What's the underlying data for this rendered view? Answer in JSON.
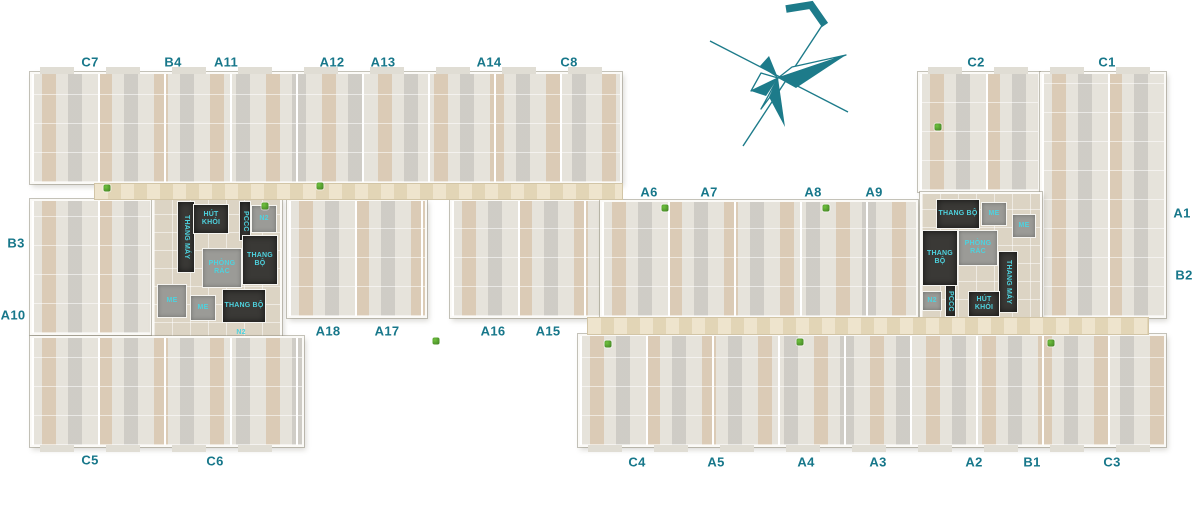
{
  "colors": {
    "label": "#17778a",
    "compass": "#1d7b8a",
    "core_text": "#4ed2de",
    "core_dark": "#3a3936",
    "room_gray": "#9b9b97",
    "floor": "#e6e3db",
    "corridor": "#e9ddc1"
  },
  "compass": {
    "icon": "compass-rose-north-arrow"
  },
  "unit_labels": [
    {
      "text": "C7",
      "x": 90,
      "y": 62
    },
    {
      "text": "B4",
      "x": 173,
      "y": 62
    },
    {
      "text": "A11",
      "x": 226,
      "y": 62
    },
    {
      "text": "A12",
      "x": 332,
      "y": 62
    },
    {
      "text": "A13",
      "x": 383,
      "y": 62
    },
    {
      "text": "A14",
      "x": 489,
      "y": 62
    },
    {
      "text": "C8",
      "x": 569,
      "y": 62
    },
    {
      "text": "C2",
      "x": 976,
      "y": 62
    },
    {
      "text": "C1",
      "x": 1107,
      "y": 62
    },
    {
      "text": "A6",
      "x": 649,
      "y": 192
    },
    {
      "text": "A7",
      "x": 709,
      "y": 192
    },
    {
      "text": "A8",
      "x": 813,
      "y": 192
    },
    {
      "text": "A9",
      "x": 874,
      "y": 192
    },
    {
      "text": "A1",
      "x": 1182,
      "y": 213
    },
    {
      "text": "B2",
      "x": 1184,
      "y": 275
    },
    {
      "text": "B3",
      "x": 16,
      "y": 243
    },
    {
      "text": "A10",
      "x": 13,
      "y": 315
    },
    {
      "text": "A18",
      "x": 328,
      "y": 331
    },
    {
      "text": "A17",
      "x": 387,
      "y": 331
    },
    {
      "text": "A16",
      "x": 493,
      "y": 331
    },
    {
      "text": "A15",
      "x": 548,
      "y": 331
    },
    {
      "text": "C5",
      "x": 90,
      "y": 460
    },
    {
      "text": "C6",
      "x": 215,
      "y": 461
    },
    {
      "text": "C4",
      "x": 637,
      "y": 462
    },
    {
      "text": "A5",
      "x": 716,
      "y": 462
    },
    {
      "text": "A4",
      "x": 806,
      "y": 462
    },
    {
      "text": "A3",
      "x": 878,
      "y": 462
    },
    {
      "text": "A2",
      "x": 974,
      "y": 462
    },
    {
      "text": "B1",
      "x": 1032,
      "y": 462
    },
    {
      "text": "C3",
      "x": 1112,
      "y": 462
    }
  ],
  "core_rooms": [
    {
      "text": "THANG MÁY",
      "x": 186,
      "y": 237,
      "w": 18,
      "h": 72,
      "style": "dark",
      "vertical": true
    },
    {
      "text": "HÚT KHÓI",
      "x": 211,
      "y": 219,
      "w": 36,
      "h": 30,
      "style": "dark"
    },
    {
      "text": "PCCC",
      "x": 245,
      "y": 221,
      "w": 12,
      "h": 40,
      "style": "dark",
      "vertical": true
    },
    {
      "text": "N2",
      "x": 264,
      "y": 219,
      "w": 26,
      "h": 28,
      "style": "gray"
    },
    {
      "text": "PHÒNG RÁC",
      "x": 222,
      "y": 268,
      "w": 40,
      "h": 40,
      "style": "gray"
    },
    {
      "text": "THANG BỘ",
      "x": 260,
      "y": 260,
      "w": 36,
      "h": 50,
      "style": "dark"
    },
    {
      "text": "ME",
      "x": 172,
      "y": 301,
      "w": 30,
      "h": 34,
      "style": "gray"
    },
    {
      "text": "ME",
      "x": 203,
      "y": 308,
      "w": 26,
      "h": 26,
      "style": "gray"
    },
    {
      "text": "THANG BỘ",
      "x": 244,
      "y": 306,
      "w": 44,
      "h": 34,
      "style": "dark"
    },
    {
      "text": "N2",
      "x": 241,
      "y": 333,
      "w": 40,
      "h": 16,
      "style": "floor"
    },
    {
      "text": "THANG BỘ",
      "x": 958,
      "y": 214,
      "w": 44,
      "h": 30,
      "style": "dark"
    },
    {
      "text": "ME",
      "x": 994,
      "y": 214,
      "w": 26,
      "h": 24,
      "style": "gray"
    },
    {
      "text": "ME",
      "x": 1024,
      "y": 226,
      "w": 24,
      "h": 24,
      "style": "gray"
    },
    {
      "text": "THANG BỘ",
      "x": 940,
      "y": 258,
      "w": 36,
      "h": 56,
      "style": "dark"
    },
    {
      "text": "PHÒNG RÁC",
      "x": 978,
      "y": 248,
      "w": 40,
      "h": 36,
      "style": "gray"
    },
    {
      "text": "THANG MÁY",
      "x": 1008,
      "y": 282,
      "w": 20,
      "h": 62,
      "style": "dark",
      "vertical": true
    },
    {
      "text": "N2",
      "x": 932,
      "y": 301,
      "w": 20,
      "h": 20,
      "style": "gray"
    },
    {
      "text": "PCCC",
      "x": 950,
      "y": 301,
      "w": 11,
      "h": 32,
      "style": "dark",
      "vertical": true
    },
    {
      "text": "HÚT KHÓI",
      "x": 984,
      "y": 304,
      "w": 32,
      "h": 26,
      "style": "dark"
    }
  ],
  "plants": [
    [
      107,
      188
    ],
    [
      320,
      186
    ],
    [
      265,
      206
    ],
    [
      436,
      341
    ],
    [
      608,
      344
    ],
    [
      800,
      342
    ],
    [
      665,
      208
    ],
    [
      826,
      208
    ],
    [
      938,
      127
    ],
    [
      1051,
      343
    ]
  ]
}
